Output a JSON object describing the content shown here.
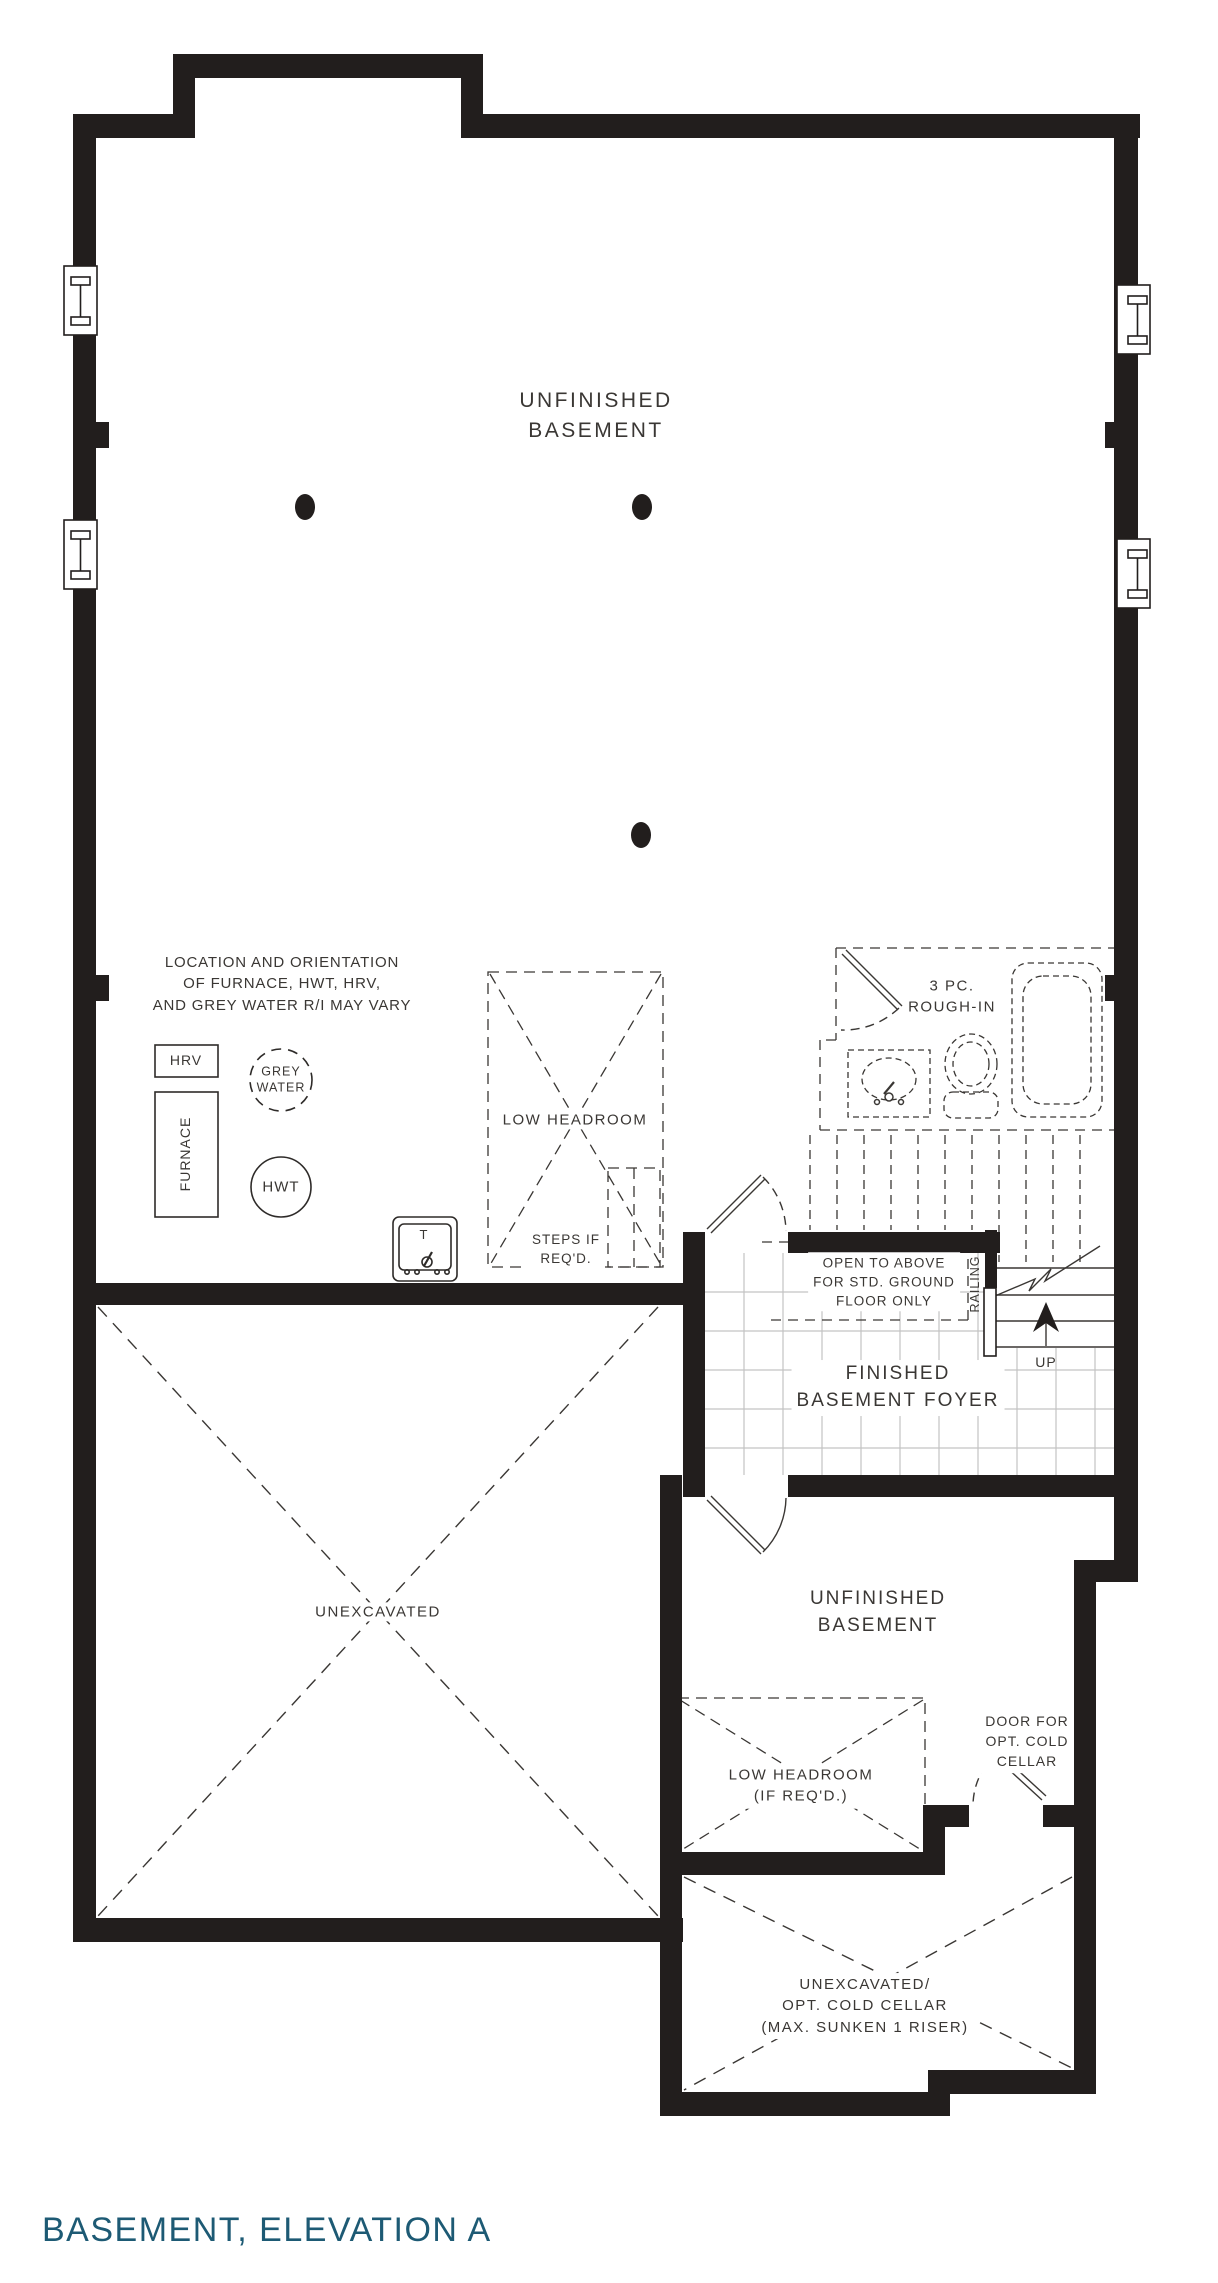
{
  "title": "BASEMENT, ELEVATION A",
  "accent_color": "#1d5a74",
  "rooms": {
    "unfinished_basement_top": "UNFINISHED\nBASEMENT",
    "finished_basement_foyer": "FINISHED\nBASEMENT FOYER",
    "unfinished_basement_right": "UNFINISHED\nBASEMENT",
    "unexcavated": "UNEXCAVATED",
    "cold_cellar": "UNEXCAVATED/\nOPT. COLD CELLAR\n(MAX. SUNKEN 1 RISER)"
  },
  "annotations": {
    "mech_note": "LOCATION AND ORIENTATION\nOF FURNACE, HWT, HRV,\nAND GREY WATER R/I MAY VARY",
    "low_headroom": "LOW HEADROOM",
    "steps_if_reqd": "STEPS IF\nREQ'D.",
    "rough_in": "3 PC.\nROUGH-IN",
    "open_to_above": "OPEN TO ABOVE\nFOR STD. GROUND\nFLOOR ONLY",
    "railing": "RAILING",
    "up": "UP",
    "low_headroom_if_reqd": "LOW HEADROOM\n(IF REQ'D.)",
    "door_cold_cellar": "DOOR FOR\nOPT. COLD\nCELLAR"
  },
  "equipment": {
    "hrv": "HRV",
    "grey_water": "GREY\nWATER",
    "furnace": "FURNACE",
    "hwt": "HWT",
    "laundry_tub": "T"
  }
}
